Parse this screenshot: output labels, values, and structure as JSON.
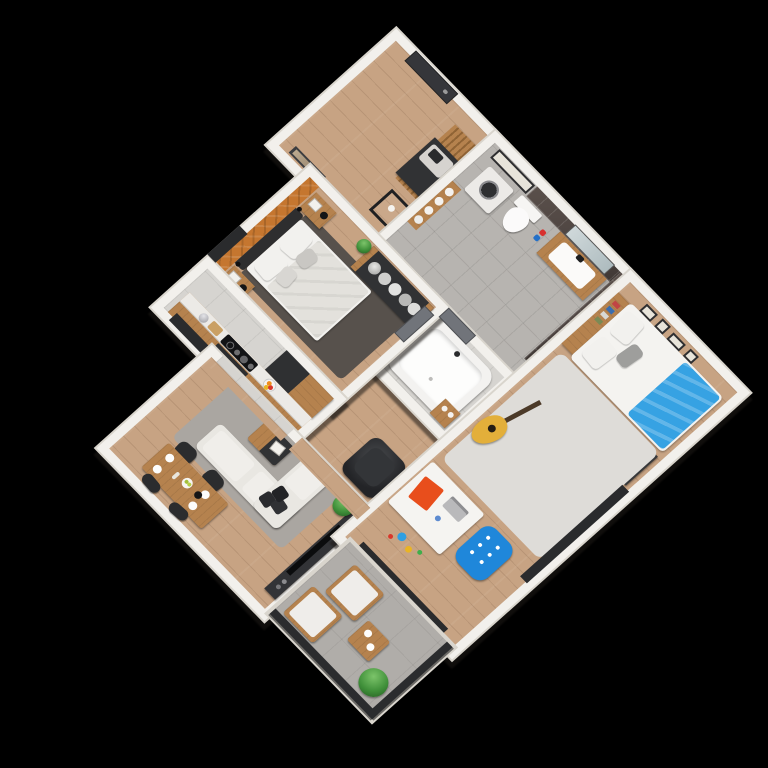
{
  "view": {
    "type": "isometric-3d-apartment-floor-plan-render",
    "projection": "isometric, rotated 45 degrees, viewed from above",
    "background": "#000000",
    "visible_text": "none"
  },
  "palette": {
    "background": "#000000",
    "wall": "#f2f0ec",
    "wallShade": "#d9d5cd",
    "woodFloor": "#c7a383",
    "woodFurniture": "#b5824e",
    "woodDark": "#8f6335",
    "tileBath": "#b7b4b0",
    "tileKitchen": "#d6d4d0",
    "tileDarkWall": "#4c4340",
    "concrete": "#b0ada9",
    "accentMosaic": "#c5762f",
    "darkFurniture": "#313234",
    "doorGray": "#71747a",
    "doorDark": "#35363a",
    "sofa": "#e9e7e2",
    "bedding": "#f2f1ee",
    "duvet": "#e3e1dc",
    "rugBedroom": "#57514c",
    "rugLiving": "#aaa6a1",
    "rugKids": "#dedcd8",
    "blue": "#1f87da",
    "blueBlanket": "#36a2e3",
    "guitarYellow": "#e3af3a",
    "orangeAccent": "#e84e1c",
    "plantGreen": "#3f8f39",
    "plantLight": "#7cc46a"
  },
  "rooms": [
    {
      "id": "entry-hall",
      "floor": "wood",
      "items": [
        "dark-entry-door",
        "wood-slat-wall-panel",
        "dark-console-bench-with-gray-cushion",
        "black-decor-stand-with-candle",
        "tall-wall-mirror"
      ]
    },
    {
      "id": "bathroom",
      "floor": "gray-tile",
      "walls": "dark-glossy-tile",
      "items": [
        "washing-machine",
        "toilet",
        "wood-vanity-with-white-sink",
        "wall-mirror",
        "towel-shelf-with-rolled-towels",
        "framed-wall-art",
        "gray-door",
        "toiletry-bottles"
      ]
    },
    {
      "id": "bathtub-room",
      "floor": "gray-tile",
      "items": [
        "white-bathtub",
        "chrome-faucet",
        "wood-towel-cabinet",
        "gray-door"
      ]
    },
    {
      "id": "master-bedroom",
      "floor": "wood",
      "accent_wall": "orange-mosaic-tiles",
      "items": [
        "double-bed-dark-frame",
        "white-gray-pillows",
        "light-duvet",
        "wood-nightstand-left-with-books-and-black-lamp",
        "wood-nightstand-right-with-books-and-black-lamp",
        "black-wall-sconces",
        "open-wardrobe-with-hanging-gray-clothes",
        "dark-gray-rug",
        "potted-plant",
        "window"
      ]
    },
    {
      "id": "kitchen",
      "floor": "light-gray-tile",
      "items": [
        "wood-cabinets-with-white-worktop",
        "black-induction-cooktop",
        "built-in-oven",
        "silver-kettle",
        "fruit-bowl-with-oranges",
        "cutting-board",
        "tall-wood-cabinet-column",
        "black-cabinet-block",
        "window"
      ]
    },
    {
      "id": "central-hallway",
      "floor": "wood",
      "items": [
        "wood-sideboard-with-dark-top",
        "black-leather-armchair",
        "potted-plants-in-white-pots"
      ]
    },
    {
      "id": "living-room",
      "floor": "wood",
      "items": [
        "white-l-shaped-sofa",
        "dark-throw-pillows",
        "wood-and-black-coffee-table-with-book",
        "gray-rug",
        "dark-tv-unit",
        "flat-screen-tv",
        "potted-plant"
      ]
    },
    {
      "id": "dining-area",
      "floor": "wood",
      "items": [
        "wood-dining-table",
        "four-black-chairs",
        "white-plates",
        "fruit-plate",
        "black-teapot",
        "flower-vase"
      ]
    },
    {
      "id": "kids-bedroom",
      "floor": "wood",
      "items": [
        "white-single-bed",
        "blue-blanket",
        "white-pillows",
        "wood-bookshelf-headboard",
        "black-picture-frames-on-textured-wall",
        "dark-dresser",
        "light-gray-rug",
        "yellow-acoustic-guitar",
        "white-desk",
        "orange-desk-pad",
        "gray-laptop",
        "blue-desk-chair",
        "small-toys",
        "dark-balcony-door",
        "dark-window"
      ]
    },
    {
      "id": "balcony",
      "floor": "concrete",
      "items": [
        "dark-metal-glass-railing",
        "two-wood-lounge-chairs-with-white-cushions",
        "wood-side-table-with-plates",
        "palm-plant"
      ]
    }
  ]
}
